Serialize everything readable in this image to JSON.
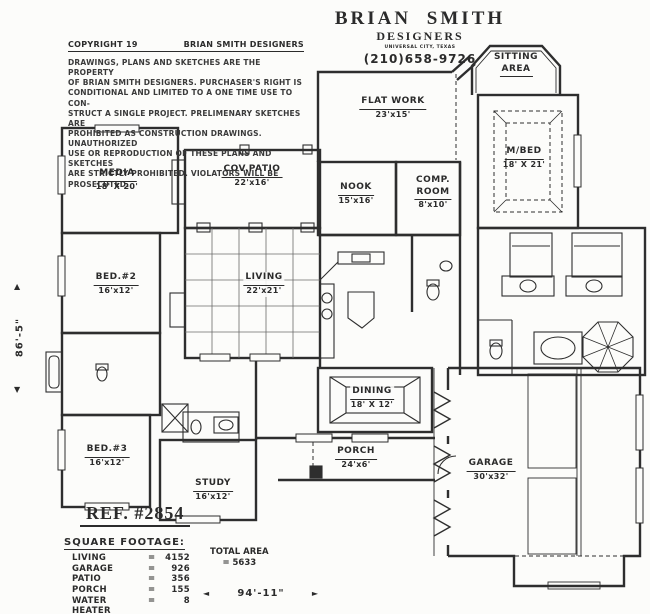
{
  "header": {
    "firm_line1": "BRIAN SMITH",
    "firm_line2": "DESIGNERS",
    "firm_line3": "UNIVERSAL CITY, TEXAS",
    "phone": "(210)658-9726"
  },
  "copyright": {
    "heading_left": "COPYRIGHT 19",
    "heading_right": "BRIAN SMITH DESIGNERS",
    "lines": [
      "DRAWINGS, PLANS AND SKETCHES ARE THE PROPERTY",
      "OF BRIAN SMITH DESIGNERS.  PURCHASER'S RIGHT IS",
      "CONDITIONAL AND LIMITED TO A ONE TIME USE TO CON-",
      "STRUCT A SINGLE PROJECT.  PRELIMENARY SKETCHES ARE",
      "PROHIBITED AS CONSTRUCTION DRAWINGS.  UNAUTHORIZED",
      "USE OR REPRODUCTION OF THESE PLANS AND SKETCHES",
      "ARE STRICTLY PROHIBITED.  VIOLATORS WILL BE PROSECUTED."
    ]
  },
  "rooms": {
    "media": {
      "name": "MEDIA",
      "size": "18' X 20'"
    },
    "cov_patio": {
      "name": "COV.PATIO",
      "size": "22'x16'"
    },
    "flat_work": {
      "name": "FLAT WORK",
      "size": "23'x15'"
    },
    "nook": {
      "name": "NOOK",
      "size": "15'x16'"
    },
    "comp_room": {
      "name_line1": "COMP.",
      "name_line2": "ROOM",
      "size": "8'x10'"
    },
    "sitting": {
      "name_line1": "SITTING",
      "name_line2": "AREA"
    },
    "m_bed": {
      "name": "M/BED",
      "size": "18' X 21'"
    },
    "bed2": {
      "name": "BED.#2",
      "size": "16'x12'"
    },
    "living": {
      "name": "LIVING",
      "size": "22'x21'"
    },
    "dining": {
      "name": "DINING",
      "size": "18' X 12'"
    },
    "bed3": {
      "name": "BED.#3",
      "size": "16'x12'"
    },
    "study": {
      "name": "STUDY",
      "size": "16'x12'"
    },
    "porch": {
      "name": "PORCH",
      "size": "24'x6'"
    },
    "garage": {
      "name": "GARAGE",
      "size": "30'x32'"
    }
  },
  "reference": {
    "label": "REF. #2854"
  },
  "square_footage": {
    "heading": "SQUARE FOOTAGE:",
    "rows": [
      {
        "label": "LIVING",
        "eq": "=",
        "value": "4152"
      },
      {
        "label": "GARAGE",
        "eq": "=",
        "value": "926"
      },
      {
        "label": "PATIO",
        "eq": "=",
        "value": "356"
      },
      {
        "label": "PORCH",
        "eq": "=",
        "value": "155"
      },
      {
        "label": "WATER HEATER",
        "eq": "=",
        "value": "8"
      }
    ],
    "total_label": "TOTAL AREA",
    "total_value": "= 5633"
  },
  "dimensions": {
    "height": "86'-5\"",
    "width": "94'-11\""
  },
  "icons": {
    "up_arrow": "▲",
    "down_arrow": "▼",
    "left_arrow": "◄",
    "right_arrow": "►"
  },
  "colors": {
    "ink": "#2e2e2e",
    "paper": "#fcfcfa"
  }
}
